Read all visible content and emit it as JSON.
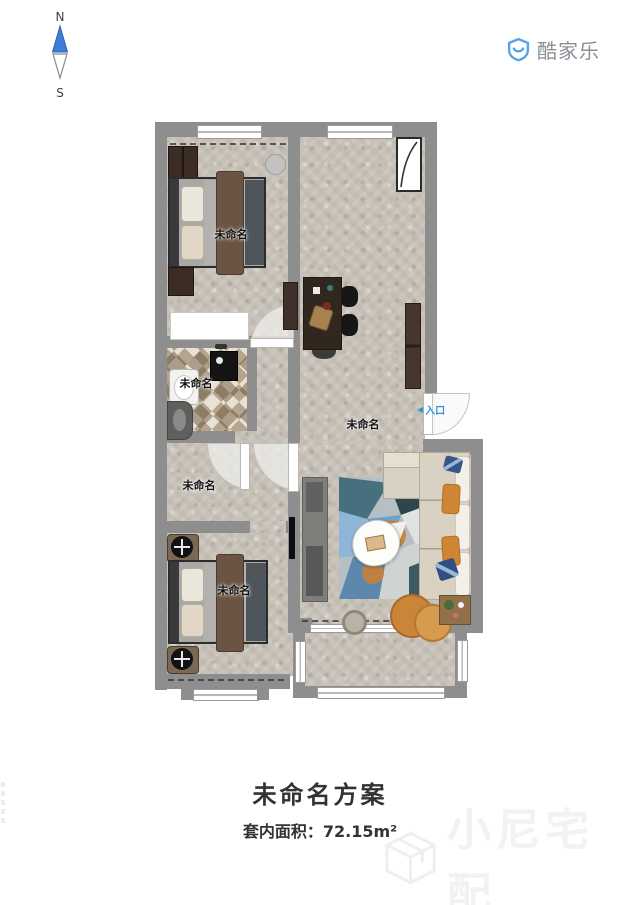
{
  "compass": {
    "north": "N",
    "south": "S"
  },
  "logo": {
    "text": "酷家乐"
  },
  "rooms": {
    "bedroom_top": {
      "label": "未命名"
    },
    "bathroom": {
      "label": "未命名"
    },
    "living": {
      "label": "未命名"
    },
    "hall": {
      "label": "未命名"
    },
    "bedroom_bottom": {
      "label": "未命名"
    }
  },
  "entrance": {
    "label": "入口"
  },
  "icons": {
    "entrance_arrow": "◀"
  },
  "footer": {
    "title": "未命名方案",
    "area": "套内面积：72.15m²"
  },
  "watermark": {
    "text": "小尼宅配"
  },
  "palette": {
    "wall_gray": "#8e8e8e",
    "floor_beige": "#c7c1b8",
    "accent_blue": "#2f96d8",
    "logo_blue": "#57a3e9",
    "logo_text_gray": "#8a9095",
    "sofa_cream": "#d9d1c2",
    "pillow_orange": "#cf8633",
    "pillow_navy": "#35568a",
    "wood_dark": "#3b2d25",
    "title_color": "#333333",
    "watermark_color": "#f2f2f2"
  }
}
